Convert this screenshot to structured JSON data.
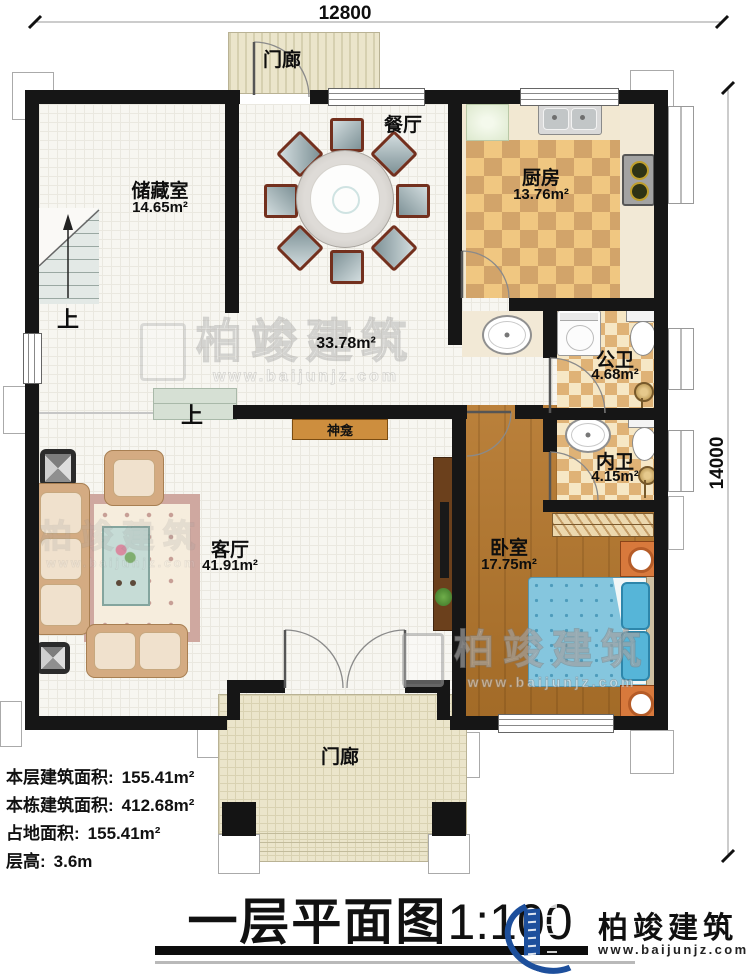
{
  "dimensions": {
    "width_label": "12800",
    "height_label": "14000"
  },
  "rooms": {
    "porch_top": {
      "name": "门廊"
    },
    "storage": {
      "name": "储藏室",
      "area": "14.65m²"
    },
    "dining": {
      "name": "餐厅"
    },
    "kitchen": {
      "name": "厨房",
      "area": "13.76m²"
    },
    "hallway": {
      "area": "33.78m²"
    },
    "public_bath": {
      "name": "公卫",
      "area": "4.68m²"
    },
    "private_bath": {
      "name": "内卫",
      "area": "4.15m²"
    },
    "living": {
      "name": "客厅",
      "area": "41.91m²"
    },
    "bedroom": {
      "name": "卧室",
      "area": "17.75m²"
    },
    "porch_bottom": {
      "name": "门廊"
    }
  },
  "annotations": {
    "shrine": "神龛",
    "stairs_up": "上",
    "step_up": "上"
  },
  "stats": {
    "floor_area_label": "本层建筑面积:",
    "floor_area_value": "155.41m²",
    "building_area_label": "本栋建筑面积:",
    "building_area_value": "412.68m²",
    "land_area_label": "占地面积:",
    "land_area_value": "155.41m²",
    "floor_height_label": "层高:",
    "floor_height_value": "3.6m"
  },
  "title": {
    "main": "一层平面图",
    "scale": "1:100"
  },
  "brand": {
    "name": "柏竣建筑",
    "website": "www.baijunjz.com"
  },
  "watermark": {
    "name": "柏竣建筑",
    "website": "www.baijunjz.com"
  },
  "colors": {
    "wall": "#161616",
    "wood_floor": "#b5772c",
    "kitchen_tile": "#f0c781",
    "bath_tile": "#dfb276",
    "porch": "#ebe5cb",
    "shrine_bar": "#cd8e3e",
    "bed_blue": "#85c6de",
    "brand_blue": "#1d4f9c",
    "brand_orange": "#f08519"
  }
}
